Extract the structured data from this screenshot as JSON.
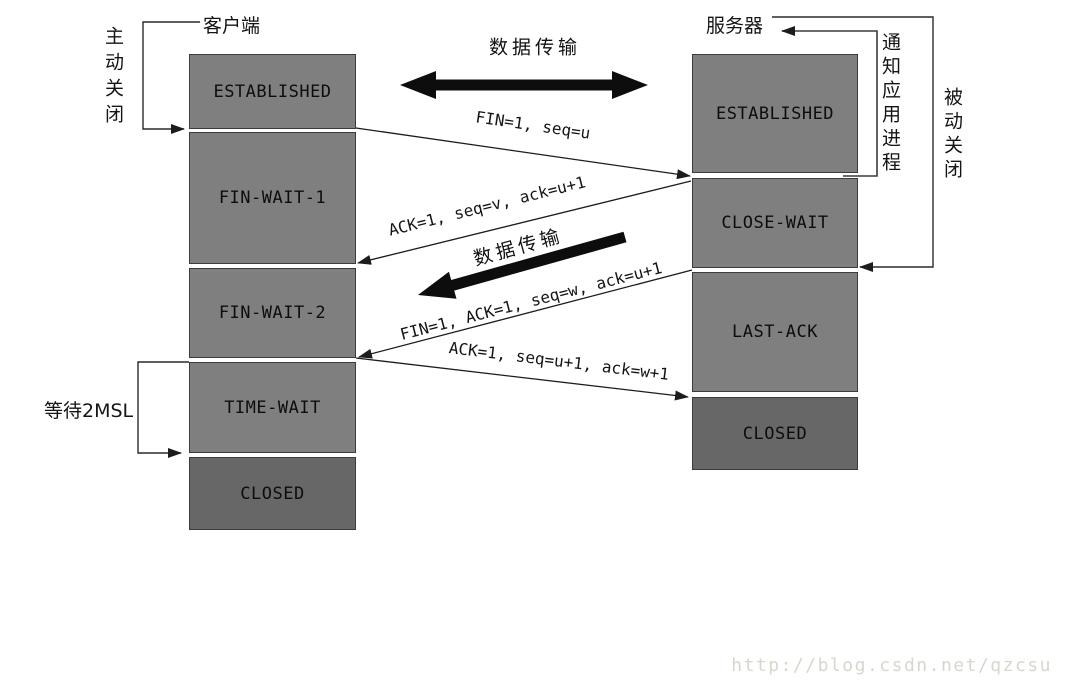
{
  "diagram": {
    "title_hint": "TCP connection release (four-way wave) state diagram",
    "watermark": "http://blog.csdn.net/qzcsu"
  },
  "colors": {
    "state_box": "#7f7f7f",
    "closed_box": "#676767",
    "box_border": "#3c3c3c",
    "line": "#1c1c1c",
    "watermark": "#d9d6ce"
  },
  "client": {
    "title": "客户端",
    "active_close_note": "主动关闭",
    "wait_2msl_note": "等待2MSL",
    "states": [
      {
        "label": "ESTABLISHED"
      },
      {
        "label": "FIN-WAIT-1"
      },
      {
        "label": "FIN-WAIT-2"
      },
      {
        "label": "TIME-WAIT"
      },
      {
        "label": "CLOSED"
      }
    ]
  },
  "server": {
    "title": "服务器",
    "passive_close_note": "被动关闭",
    "notify_app_note": "通知应用进程",
    "states": [
      {
        "label": "ESTABLISHED"
      },
      {
        "label": "CLOSE-WAIT"
      },
      {
        "label": "LAST-ACK"
      },
      {
        "label": "CLOSED"
      }
    ]
  },
  "messages": {
    "data_transfer_top": "数据传输",
    "data_transfer_mid": "数据传输",
    "fin_seq_u": "FIN=1, seq=u",
    "ack_seq_v": "ACK=1, seq=v, ack=u+1",
    "fin_ack_seq_w": "FIN=1, ACK=1, seq=w, ack=u+1",
    "ack_seq_u1": "ACK=1, seq=u+1, ack=w+1"
  }
}
